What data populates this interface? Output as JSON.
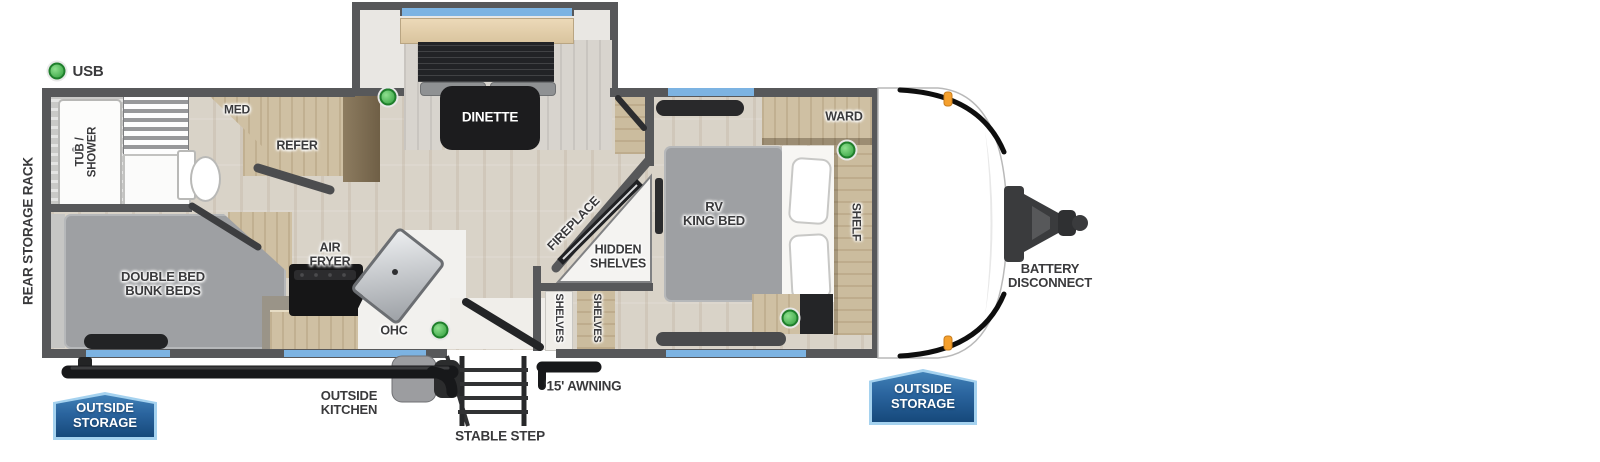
{
  "colors": {
    "wall": "#57585a",
    "floor_wood": "#d9d3c8",
    "window_blue": "#7cb3e2",
    "mattress_gray": "#9ea0a3",
    "cabinet_tan": "#cfc0a3",
    "badge_blue": "#2a649e",
    "badge_border_blue": "#a5d2ef",
    "usb_green": "#3fae49",
    "marker_orange": "#f5a02d",
    "table_black": "#1c1c1e"
  },
  "legend": {
    "usb": "USB"
  },
  "exterior": {
    "rear_storage_rack": "REAR STORAGE RACK",
    "battery_disconnect": "BATTERY\nDISCONNECT",
    "outside_storage_left": "OUTSIDE\nSTORAGE",
    "outside_storage_right": "OUTSIDE\nSTORAGE",
    "outside_kitchen": "OUTSIDE\nKITCHEN",
    "stable_step": "STABLE STEP",
    "awning": "15' AWNING"
  },
  "rooms": {
    "tub_shower": "TUB /\nSHOWER",
    "med": "MED",
    "refer": "REFER",
    "dinette": "DINETTE",
    "double_bunk": "DOUBLE BED\nBUNK BEDS",
    "air_fryer": "AIR\nFRYER",
    "ohc": "OHC",
    "fireplace": "FIREPLACE",
    "hidden_shelves": "HIDDEN\nSHELVES",
    "shelves_a": "SHELVES",
    "shelves_b": "SHELVES",
    "rv_king_bed": "RV\nKING BED",
    "ward": "WARD",
    "shelf": "SHELF"
  }
}
